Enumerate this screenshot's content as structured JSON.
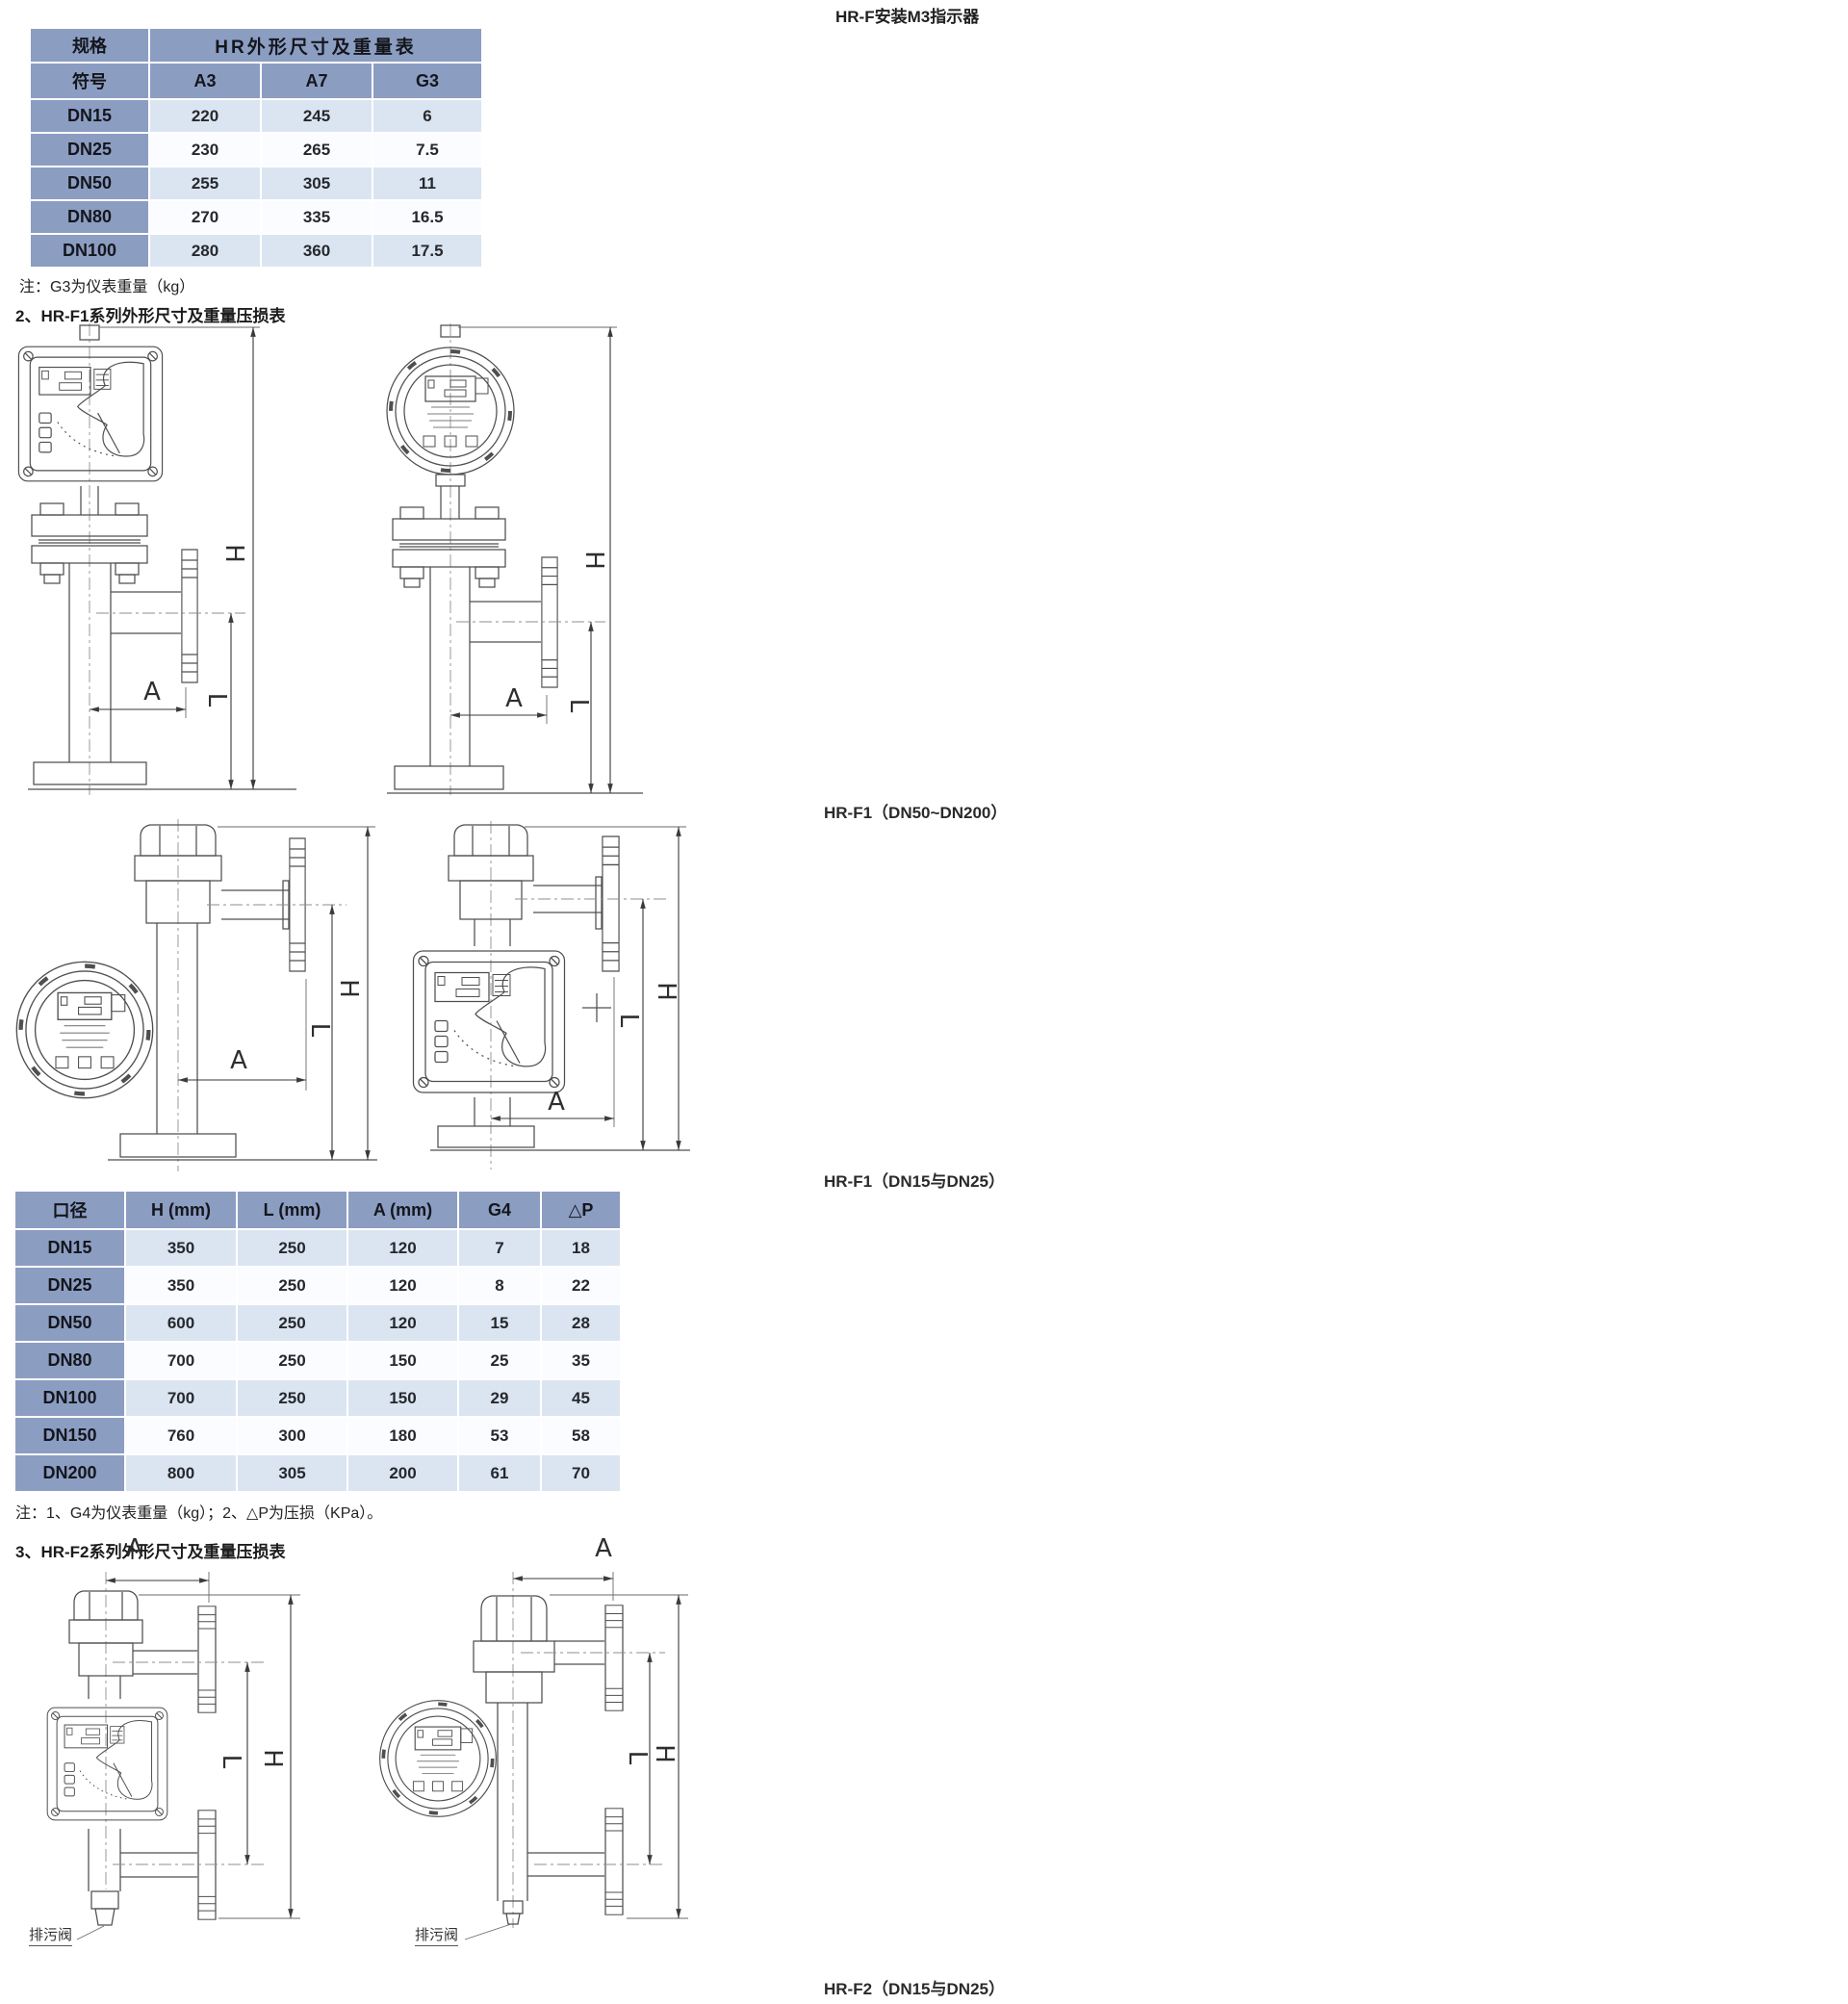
{
  "page": {
    "top_right_title": "HR-F安装M3指示器",
    "table1_note": "注：G3为仪表重量（kg）",
    "section2_heading": "2、HR-F1系列外形尺寸及重量压损表",
    "section3_heading": "3、HR-F2系列外形尺寸及重量压损表",
    "table2_note": "注：1、G4为仪表重量（kg）；2、△P为压损（KPa）。",
    "caption_f1_large": "HR-F1（DN50~DN200）",
    "caption_f1_small": "HR-F1（DN15与DN25）",
    "caption_f2_small": "HR-F2（DN15与DN25）"
  },
  "labels": {
    "dim_h": "H",
    "dim_l": "L",
    "dim_a": "A",
    "drain_valve": "排污阀"
  },
  "table1": {
    "corner": "规格",
    "title": "HR外形尺寸及重量表",
    "symbol_header": "符号",
    "columns": [
      "A3",
      "A7",
      "G3"
    ],
    "rows": [
      [
        "DN15",
        "220",
        "245",
        "6"
      ],
      [
        "DN25",
        "230",
        "265",
        "7.5"
      ],
      [
        "DN50",
        "255",
        "305",
        "11"
      ],
      [
        "DN80",
        "270",
        "335",
        "16.5"
      ],
      [
        "DN100",
        "280",
        "360",
        "17.5"
      ]
    ]
  },
  "table2": {
    "columns": [
      "口径",
      "H (mm)",
      "L (mm)",
      "A (mm)",
      "G4",
      "△P"
    ],
    "rows": [
      [
        "DN15",
        "350",
        "250",
        "120",
        "7",
        "18"
      ],
      [
        "DN25",
        "350",
        "250",
        "120",
        "8",
        "22"
      ],
      [
        "DN50",
        "600",
        "250",
        "120",
        "15",
        "28"
      ],
      [
        "DN80",
        "700",
        "250",
        "150",
        "25",
        "35"
      ],
      [
        "DN100",
        "700",
        "250",
        "150",
        "29",
        "45"
      ],
      [
        "DN150",
        "760",
        "300",
        "180",
        "53",
        "58"
      ],
      [
        "DN200",
        "800",
        "305",
        "200",
        "61",
        "70"
      ]
    ]
  },
  "colors": {
    "table_header_blue": "#8c9dc2",
    "row_tint_blue": "#dbe5f2",
    "row_tint_light": "#fafcff",
    "line_color": "#4f4f4f"
  }
}
